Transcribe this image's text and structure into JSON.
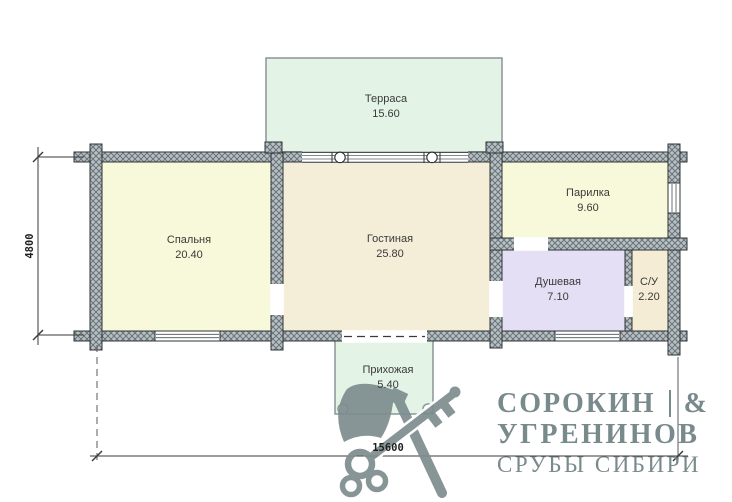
{
  "plan": {
    "rooms": [
      {
        "id": "terrace",
        "name": "Терраса",
        "area": "15.60"
      },
      {
        "id": "bedroom",
        "name": "Спальня",
        "area": "20.40"
      },
      {
        "id": "living",
        "name": "Гостиная",
        "area": "25.80"
      },
      {
        "id": "sauna",
        "name": "Парилка",
        "area": "9.60"
      },
      {
        "id": "shower",
        "name": "Душевая",
        "area": "7.10"
      },
      {
        "id": "wc",
        "name": "С/У",
        "area": "2.20"
      },
      {
        "id": "hall",
        "name": "Прихожая",
        "area": "5.40"
      }
    ],
    "dimensions": {
      "vertical": "4800",
      "horizontal": "15600"
    }
  },
  "branding": {
    "name_top": "СОРОКИН",
    "ampersand": "&",
    "name_bottom": "УГРЕНИНОВ",
    "tagline": "СРУБЫ СИБИРИ"
  },
  "colors": {
    "wall_base": "#b9c0c3",
    "wall_hatch": "#67737a",
    "terrace_fill": "#e3f3e6",
    "bedroom_fill": "#f8f8da",
    "living_fill": "#f4edd8",
    "sauna_fill": "#f8f8da",
    "shower_fill": "#e4dff4",
    "wc_fill": "#f4ecd4",
    "hall_fill": "#e3f3e6",
    "brand": "#798a8c",
    "line": "#3a3a3a"
  }
}
